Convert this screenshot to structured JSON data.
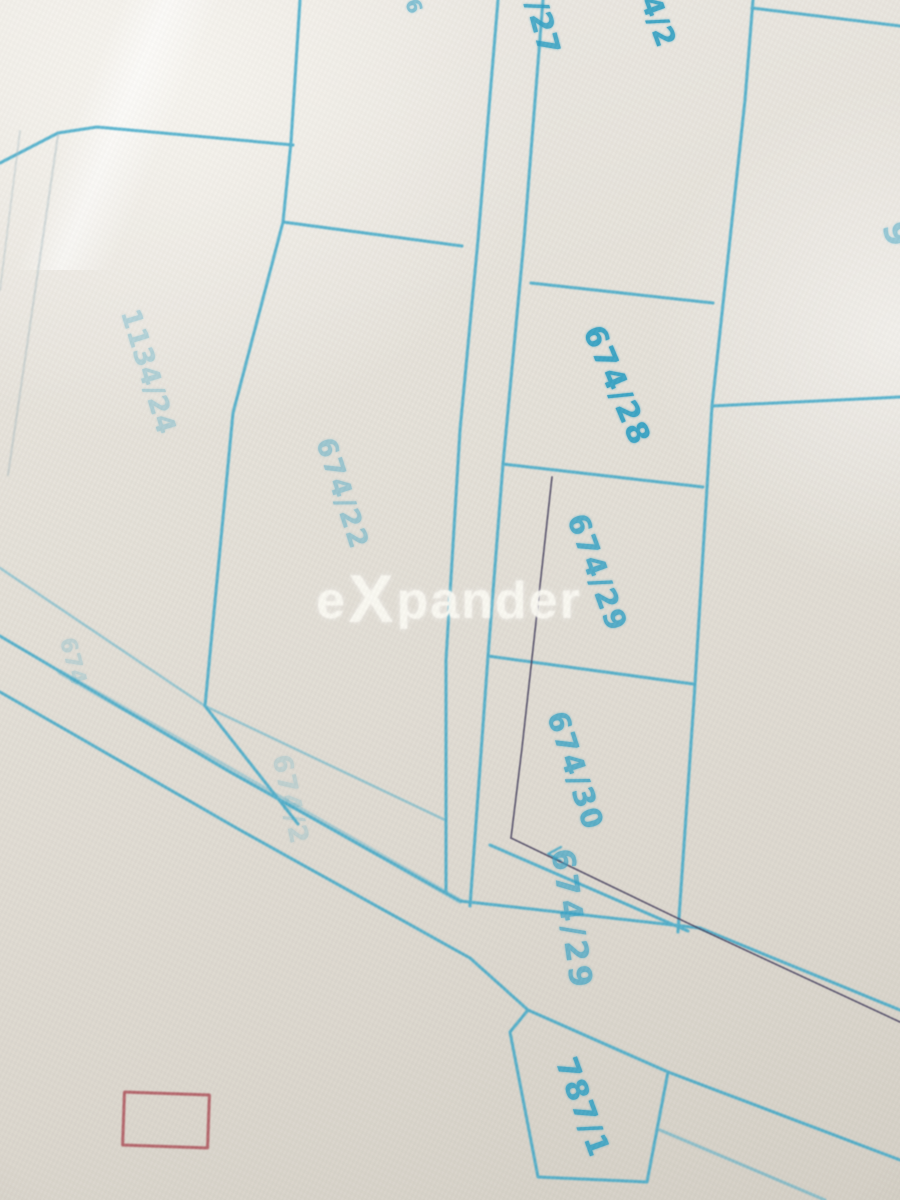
{
  "photo": {
    "description": "blurred photo of a cadastral parcel map, blue ink on light paper",
    "colors": {
      "paper": "#e6e2da",
      "parcel_line": "#35a5c8",
      "dark_survey_line": "#453f5d",
      "label_ink": "#2e9fc3",
      "stamp_red": "#a8454f",
      "watermark_white": "#faf8f2"
    }
  },
  "watermark": {
    "text_before_x": "e",
    "x_letter": "X",
    "text_after_x": "pander"
  },
  "labels": [
    {
      "name": "label-674-27-partial",
      "text": "/27",
      "x": 542,
      "y": 28,
      "rot": 75,
      "size": 30,
      "opacity": 0.85,
      "spacing": 1
    },
    {
      "name": "label-674-2-partial",
      "text": "4/2",
      "x": 658,
      "y": 22,
      "rot": 70,
      "size": 28,
      "opacity": 0.9,
      "spacing": 1
    },
    {
      "name": "label-6-partial",
      "text": "6",
      "x": 414,
      "y": 6,
      "rot": 70,
      "size": 20,
      "opacity": 0.55,
      "spacing": 0
    },
    {
      "name": "label-1134-24",
      "text": "1134/24",
      "x": 148,
      "y": 372,
      "rot": 73,
      "size": 27,
      "opacity": 0.3,
      "spacing": 1
    },
    {
      "name": "label-674-22",
      "text": "674/22",
      "x": 342,
      "y": 494,
      "rot": 72,
      "size": 27,
      "opacity": 0.4,
      "spacing": 2
    },
    {
      "name": "label-674-28",
      "text": "674/28",
      "x": 616,
      "y": 386,
      "rot": 67,
      "size": 30,
      "opacity": 0.92,
      "spacing": 2
    },
    {
      "name": "label-674-29",
      "text": "674/29",
      "x": 597,
      "y": 573,
      "rot": 70,
      "size": 29,
      "opacity": 0.8,
      "spacing": 2
    },
    {
      "name": "label-674-30",
      "text": "674/30",
      "x": 575,
      "y": 771,
      "rot": 72,
      "size": 29,
      "opacity": 0.75,
      "spacing": 2
    },
    {
      "name": "label-674-29-road",
      "text": "674/29",
      "x": 571,
      "y": 920,
      "rot": 82,
      "size": 31,
      "opacity": 0.65,
      "spacing": 4
    },
    {
      "name": "label-674-2-faint",
      "text": "674/2",
      "x": 290,
      "y": 800,
      "rot": 78,
      "size": 26,
      "opacity": 0.18,
      "spacing": 2
    },
    {
      "name": "label-674-faint-left",
      "text": "674",
      "x": 72,
      "y": 662,
      "rot": 75,
      "size": 22,
      "opacity": 0.2,
      "spacing": 1
    },
    {
      "name": "label-787-1",
      "text": "787/1",
      "x": 582,
      "y": 1108,
      "rot": 70,
      "size": 30,
      "opacity": 0.85,
      "spacing": 2
    },
    {
      "name": "label-9-partial",
      "text": "9",
      "x": 896,
      "y": 234,
      "rot": 75,
      "size": 34,
      "opacity": 0.45,
      "spacing": 0
    }
  ],
  "stamp": {
    "center_x": 163,
    "center_y": 1117,
    "width": 82,
    "height": 50,
    "rotation_deg": 2,
    "border_width": 3.5,
    "color": "#a8454f",
    "opacity": 0.8
  }
}
